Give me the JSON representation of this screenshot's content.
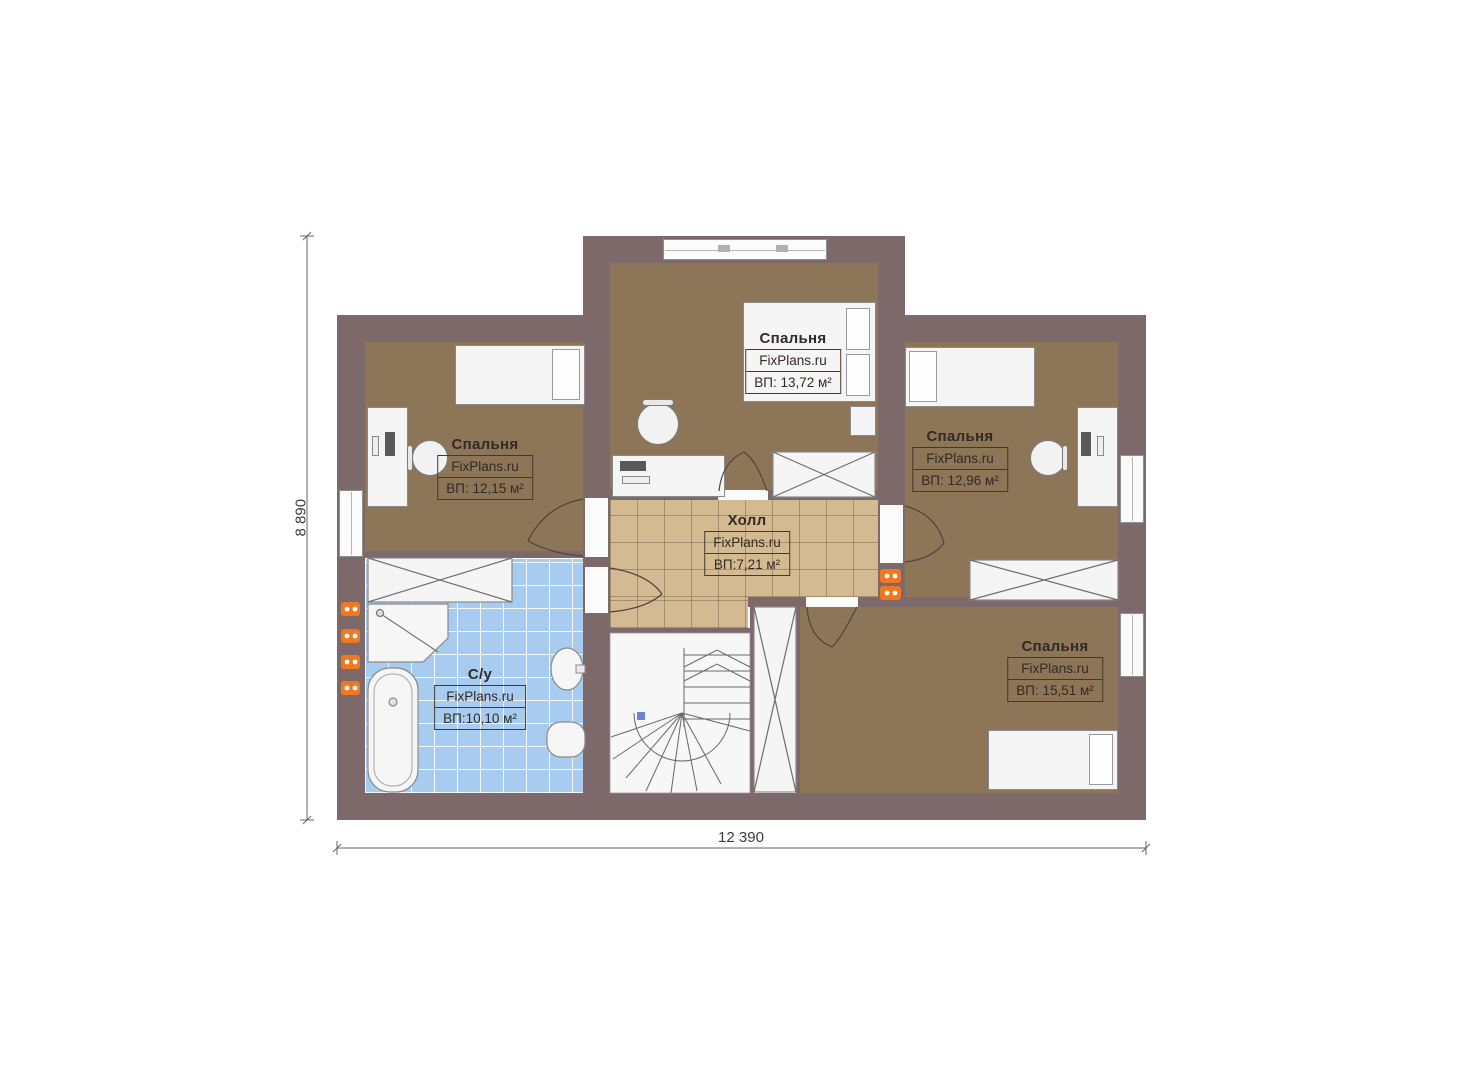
{
  "plan": {
    "title": "floor-plan-second-level",
    "watermark": "FixPlans.ru",
    "dimensions": {
      "height_label": "8 890",
      "width_label": "12 390"
    },
    "rooms": [
      {
        "id": "bedroom-top",
        "name": "Спальня",
        "area": "ВП: 13,72 м²"
      },
      {
        "id": "bedroom-left",
        "name": "Спальня",
        "area": "ВП: 12,15 м²"
      },
      {
        "id": "bedroom-right",
        "name": "Спальня",
        "area": "ВП: 12,96 м²"
      },
      {
        "id": "bedroom-bottom-right",
        "name": "Спальня",
        "area": "ВП: 15,51 м²"
      },
      {
        "id": "hall",
        "name": "Холл",
        "area": "ВП:7,21 м²"
      },
      {
        "id": "bathroom",
        "name": "С/у",
        "area": "ВП:10,10 м²"
      }
    ],
    "colors": {
      "wall": "#7d686a",
      "bedroom_floor": "#8d7557",
      "hall_floor": "#d3ba93",
      "bathroom_floor": "#a8ccf0",
      "radiator": "#f07820"
    }
  }
}
